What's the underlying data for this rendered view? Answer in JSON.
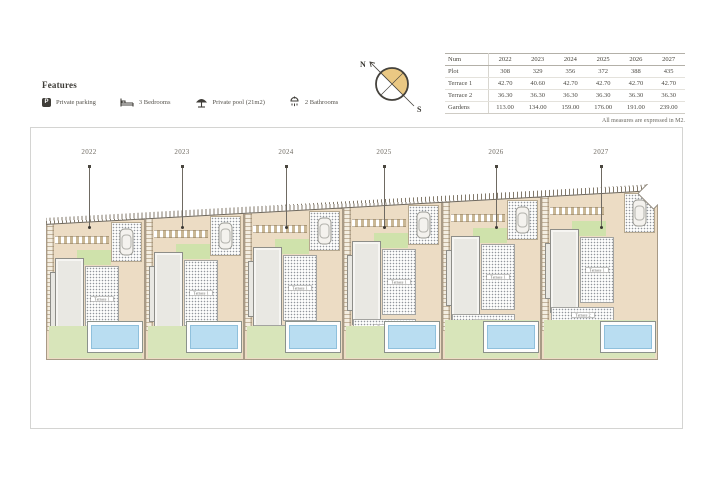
{
  "features": {
    "heading": "Features",
    "items": [
      {
        "icon": "parking-icon",
        "glyph": "P",
        "label": "Private parking"
      },
      {
        "icon": "bed-icon",
        "label": "3 Bedrooms"
      },
      {
        "icon": "pool-umbrella-icon",
        "label": "Private pool (21m2)"
      },
      {
        "icon": "bathroom-icon",
        "label": "2 Bathrooms"
      }
    ]
  },
  "compass": {
    "north": "N",
    "south": "S"
  },
  "table": {
    "header": [
      "Num",
      "2022",
      "2023",
      "2024",
      "2025",
      "2026",
      "2027"
    ],
    "rows": [
      [
        "Plot",
        "308",
        "329",
        "356",
        "372",
        "388",
        "435"
      ],
      [
        "Terrace 1",
        "42.70",
        "40.60",
        "42.70",
        "42.70",
        "42.70",
        "42.70"
      ],
      [
        "Terrace 2",
        "36.30",
        "36.30",
        "36.30",
        "36.30",
        "36.30",
        "36.30"
      ],
      [
        "Gardens",
        "113.00",
        "134.00",
        "159.00",
        "176.00",
        "191.00",
        "239.00"
      ]
    ],
    "note": "All measures are expressed in M2."
  },
  "plan": {
    "plot_labels": [
      "2022",
      "2023",
      "2024",
      "2025",
      "2026",
      "2027"
    ],
    "terrace1_label": "Terrace 1",
    "terrace2_label": "Terrace 2"
  },
  "colors": {
    "plot_tan": "#ecdcc4",
    "garden_green": "#d8e5ba",
    "accent_green": "#cfe2ab",
    "pool_blue": "#b9ddf1",
    "compass_fill": "#eac883",
    "house_gray": "#e9e8e3",
    "ink": "#45423c"
  }
}
